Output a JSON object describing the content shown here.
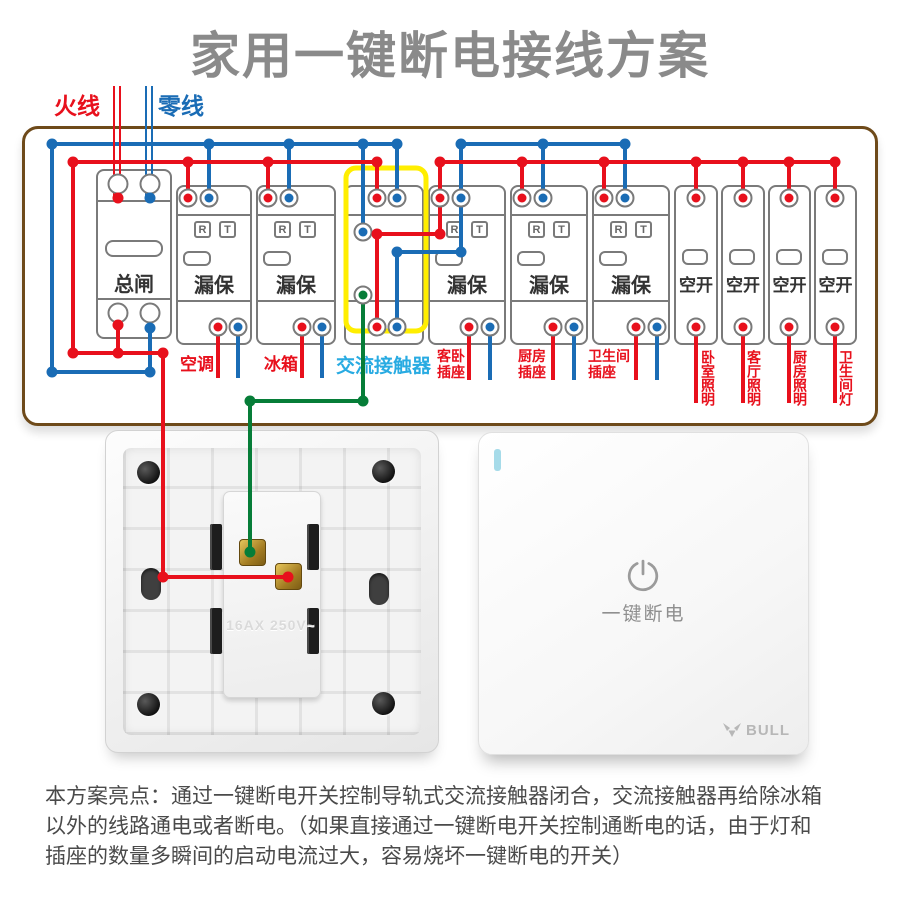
{
  "title": "家用一键断电接线方案",
  "wire_entry": {
    "live": "火线",
    "neutral": "零线"
  },
  "colors": {
    "live": "#e8101c",
    "neutral": "#1a6cb5",
    "coil": "#067d38",
    "contactor_highlight": "#ffee00",
    "box_border": "#6e4a1a",
    "contactor_label": "#29abe2",
    "title_grey": "#8a8a8a"
  },
  "breaker_row": {
    "rt_buttons": {
      "reset": "R",
      "test": "T"
    },
    "devices": [
      {
        "id": "main-breaker",
        "type": "main",
        "label": "总闸"
      },
      {
        "id": "rcbo-aircon",
        "type": "rcbo",
        "label": "漏保"
      },
      {
        "id": "rcbo-fridge",
        "type": "rcbo",
        "label": "漏保"
      },
      {
        "id": "ac-contactor",
        "type": "contactor",
        "label": ""
      },
      {
        "id": "rcbo-guest-socket",
        "type": "rcbo",
        "label": "漏保"
      },
      {
        "id": "rcbo-kitchen-socket",
        "type": "rcbo",
        "label": "漏保"
      },
      {
        "id": "rcbo-bath-socket",
        "type": "rcbo",
        "label": "漏保"
      },
      {
        "id": "mcb-bedroom-light",
        "type": "mcb",
        "label": "空开"
      },
      {
        "id": "mcb-living-light",
        "type": "mcb",
        "label": "空开"
      },
      {
        "id": "mcb-kitchen-light",
        "type": "mcb",
        "label": "空开"
      },
      {
        "id": "mcb-bath-light",
        "type": "mcb",
        "label": "空开"
      }
    ]
  },
  "circuit_labels": [
    {
      "id": "aircon",
      "text": "空调",
      "lines": [
        "空调"
      ],
      "style": "h"
    },
    {
      "id": "fridge",
      "text": "冰箱",
      "lines": [
        "冰箱"
      ],
      "style": "h"
    },
    {
      "id": "ac-contactor",
      "text": "交流接触器",
      "lines": [
        "交流接触器"
      ],
      "style": "h-blue"
    },
    {
      "id": "guest-socket",
      "text": "客卧插座",
      "lines": [
        "客卧",
        "插座"
      ],
      "style": "two-line"
    },
    {
      "id": "kitchen-socket",
      "text": "厨房插座",
      "lines": [
        "厨房",
        "插座"
      ],
      "style": "two-line"
    },
    {
      "id": "bath-socket",
      "text": "卫生间插座",
      "lines": [
        "卫生间",
        "插座"
      ],
      "style": "two-line"
    },
    {
      "id": "bedroom-light",
      "text": "卧室照明",
      "lines": [
        "卧室照明"
      ],
      "style": "v"
    },
    {
      "id": "living-light",
      "text": "客厅照明",
      "lines": [
        "客厅照明"
      ],
      "style": "v"
    },
    {
      "id": "kitchen-light",
      "text": "厨房照明",
      "lines": [
        "厨房照明"
      ],
      "style": "v"
    },
    {
      "id": "bath-light",
      "text": "卫生间灯",
      "lines": [
        "卫生间灯"
      ],
      "style": "v"
    }
  ],
  "back_panel": {
    "rating": "16AX 250V~"
  },
  "switch_panel": {
    "label": "一键断电",
    "brand": "BULL"
  },
  "footnote": {
    "lines": [
      "本方案亮点：通过一键断电开关控制导轨式交流接触器闭合，交流接触器再给除冰箱",
      "以外的线路通电或者断电。（如果直接通过一键断电开关控制通断电的话，由于灯和",
      "插座的数量多瞬间的启动电流过大，容易烧坏一键断电的开关）"
    ]
  }
}
